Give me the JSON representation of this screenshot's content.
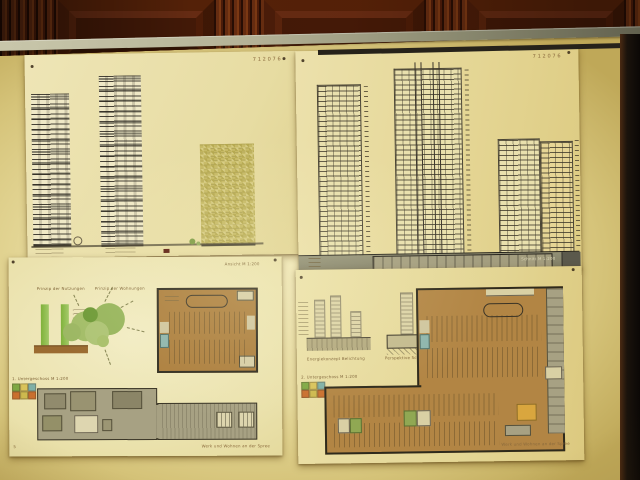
{
  "board": {
    "entry_code": "712076",
    "sheets": {
      "top_left": {
        "code": "712076"
      },
      "top_right": {
        "code": "712076",
        "band_note": "Schnitt M 1:200"
      },
      "bottom_left": {
        "scale_note": "Ansicht M 1:200",
        "principle_left_title": "Prinzip der Nutzungen",
        "principle_right_title": "Prinzip der Wohnungen",
        "legend_title": "1. Untergeschoss M 1:200",
        "page_number": "5",
        "footer": "Werk und Wohnen an der Spree"
      },
      "bottom_right": {
        "caption_left": "Energiekonzept Belichtung",
        "caption_right": "Perspektive Schnitt Baugrube",
        "legend_title": "2. Untergeschoss M 1:200",
        "footer": "Werk und Wohnen an der Spree"
      }
    },
    "legend_colors": [
      "#7fa844",
      "#d9c35a",
      "#7fb0a6",
      "#c96f2e",
      "#cdb94e",
      "#c96f2e"
    ],
    "colors": {
      "parking_plan_fill": "#b28544",
      "basement_plan_fill": "#a7a183",
      "stair_core_teal": "#8db5ad",
      "room_orange": "#d9a63e",
      "room_green": "#90a853",
      "bubble_green": "#97b55c",
      "bar_green": "#7fb13a",
      "plinth_brown": "#9b6b31",
      "wood_dark": "#4a1c08",
      "rail_gray": "#b4b296"
    }
  }
}
